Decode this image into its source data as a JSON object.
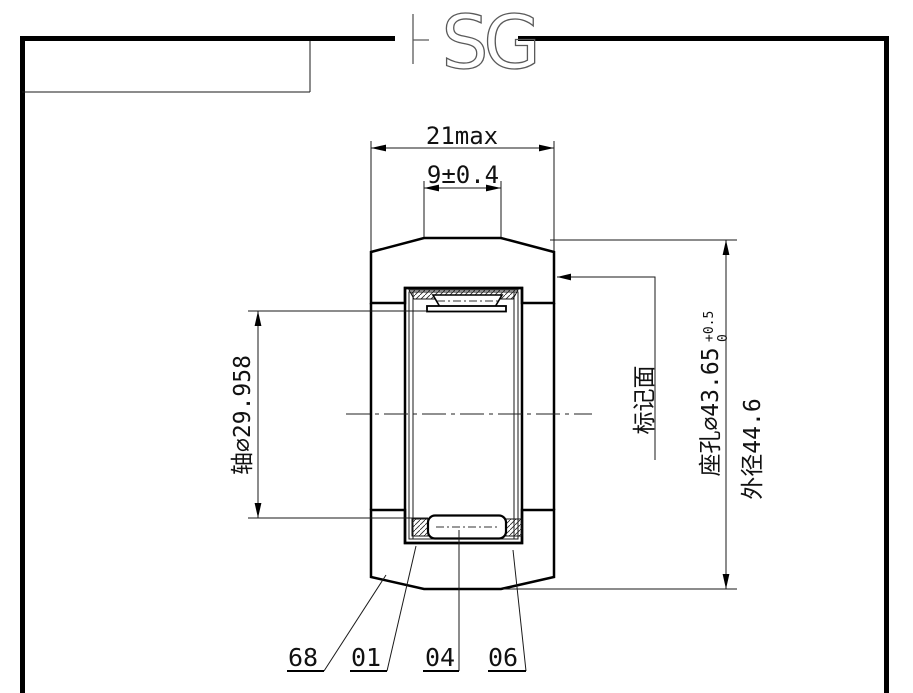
{
  "watermark": {
    "letter_s": "S",
    "letter_g": "G"
  },
  "dimensions": {
    "total_width": "21max",
    "bore_width": "9±0.4",
    "shaft_diameter": "轴∅29.958",
    "marking_face": "标记面",
    "seat_hole_diameter": "座孔∅43.65",
    "seat_tol_upper": "+0.5",
    "seat_tol_lower": "0",
    "outer_diameter": "外径44.6"
  },
  "part_labels": [
    "68",
    "01",
    "04",
    "06"
  ],
  "colors": {
    "line": "#000000",
    "watermark": "#5a5a5a",
    "background": "#ffffff"
  }
}
